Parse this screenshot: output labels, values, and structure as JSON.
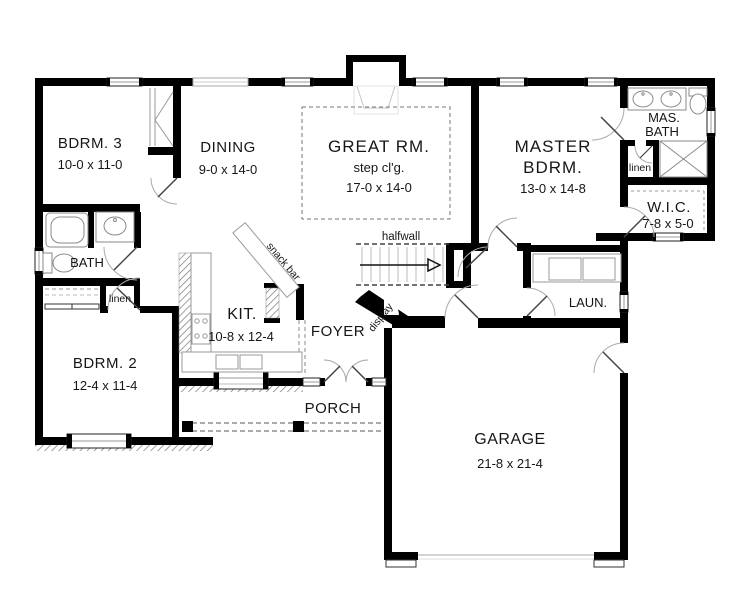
{
  "rooms": {
    "bdrm3": {
      "name": "BDRM. 3",
      "dims": "10-0 x 11-0"
    },
    "dining": {
      "name": "DINING",
      "dims": "9-0 x 14-0"
    },
    "great": {
      "name": "GREAT RM.",
      "note": "step cl'g.",
      "dims": "17-0 x 14-0"
    },
    "master": {
      "name_line1": "MASTER",
      "name_line2": "BDRM.",
      "dims": "13-0 x 14-8"
    },
    "masbath": {
      "name_line1": "MAS.",
      "name_line2": "BATH"
    },
    "linen_master": {
      "name": "linen"
    },
    "wic": {
      "name": "W.I.C.",
      "dims": "7-8 x 5-0"
    },
    "bath": {
      "name": "BATH"
    },
    "linen_hall": {
      "name": "linen"
    },
    "kitchen": {
      "name": "KIT.",
      "dims": "10-8 x 12-4"
    },
    "foyer": {
      "name": "FOYER"
    },
    "laundry": {
      "name": "LAUN."
    },
    "bdrm2": {
      "name": "BDRM. 2",
      "dims": "12-4 x 11-4"
    },
    "porch": {
      "name": "PORCH"
    },
    "garage": {
      "name": "GARAGE",
      "dims": "21-8 x 21-4"
    }
  },
  "annotations": {
    "halfwall": "halfwall",
    "snack_bar": "snack bar",
    "display": "display"
  },
  "colors": {
    "wall": "#000000",
    "background": "#ffffff",
    "fixture": "#8a8a8a",
    "dash": "#666666"
  }
}
